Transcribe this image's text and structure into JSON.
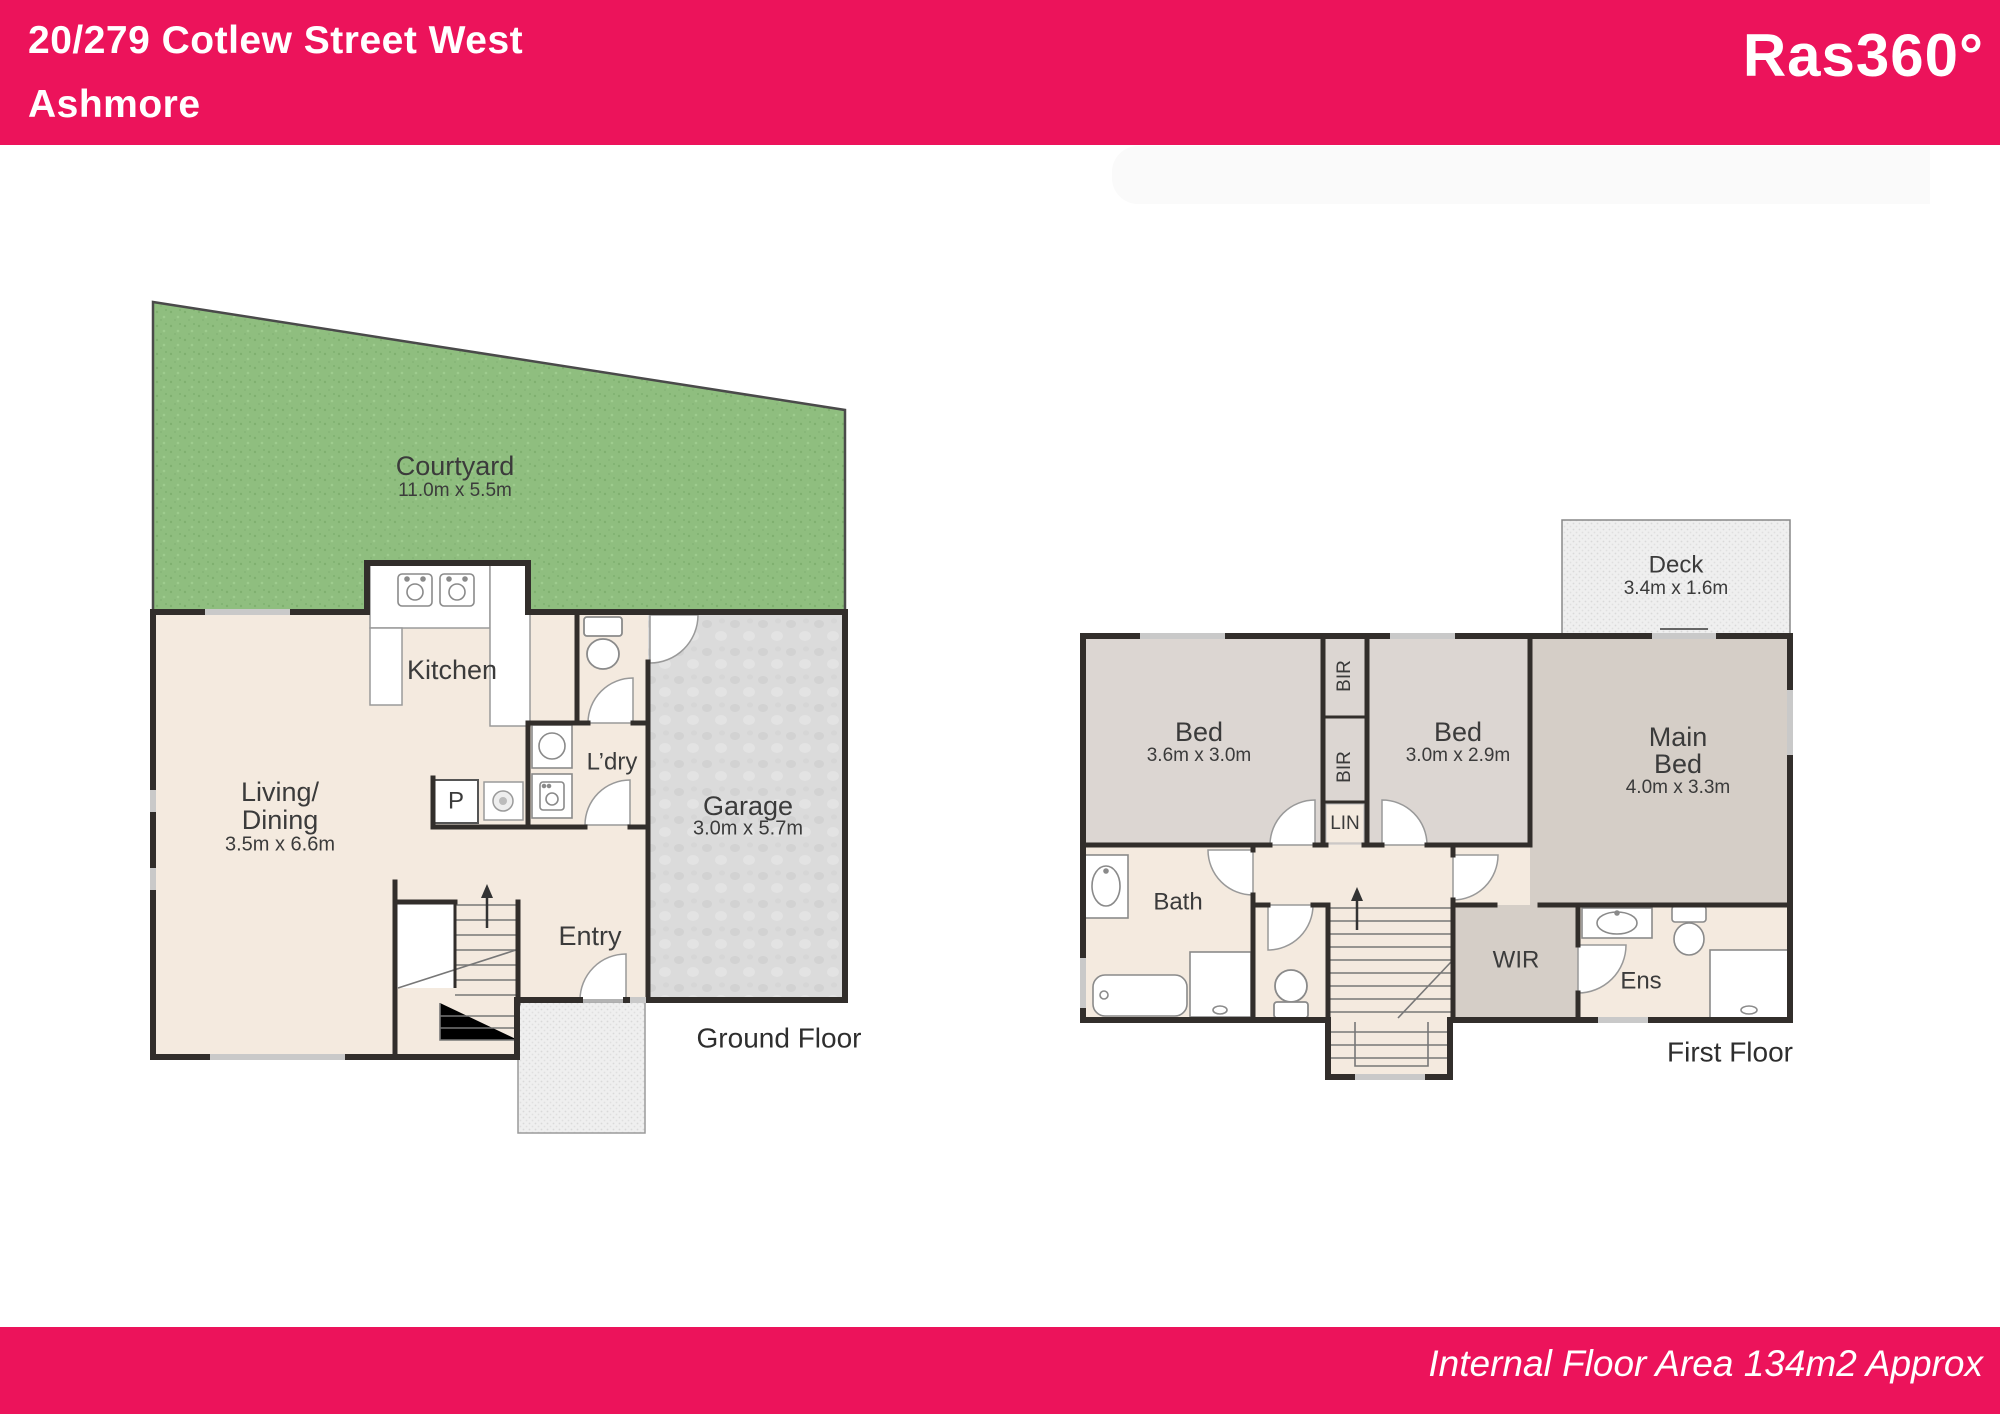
{
  "header": {
    "address_line1": "20/279 Cotlew Street West",
    "address_line2": "Ashmore",
    "brand": "Ras360°"
  },
  "footer": {
    "text": "Internal Floor Area 134m2 Approx"
  },
  "colors": {
    "brand_pink": "#EC135B",
    "courtyard_green": "#8FBE7F",
    "floor_cream": "#F4EADF",
    "room_grey": "#DCD6D2",
    "main_bed_grey": "#D5CEC7",
    "garage_grey": "#DBDBDB",
    "wall_dark": "#322E2B"
  },
  "ground_floor": {
    "label": "Ground Floor",
    "courtyard": {
      "name": "Courtyard",
      "dims": "11.0m x 5.5m"
    },
    "living": {
      "name_line1": "Living/",
      "name_line2": "Dining",
      "dims": "3.5m x 6.6m"
    },
    "kitchen": {
      "name": "Kitchen"
    },
    "laundry": {
      "name": "L’dry"
    },
    "pantry": {
      "name": "P"
    },
    "garage": {
      "name": "Garage",
      "dims": "3.0m x 5.7m"
    },
    "entry": {
      "name": "Entry"
    }
  },
  "first_floor": {
    "label": "First Floor",
    "deck": {
      "name": "Deck",
      "dims": "3.4m x 1.6m"
    },
    "bed1": {
      "name": "Bed",
      "dims": "3.6m x 3.0m"
    },
    "bed2": {
      "name": "Bed",
      "dims": "3.0m x 2.9m"
    },
    "main_bed": {
      "name_line1": "Main",
      "name_line2": "Bed",
      "dims": "4.0m x 3.3m"
    },
    "bir_top": {
      "name": "BIR"
    },
    "bir_bottom": {
      "name": "BIR"
    },
    "linen": {
      "name": "LIN"
    },
    "bath": {
      "name": "Bath"
    },
    "wir": {
      "name": "WIR"
    },
    "ens": {
      "name": "Ens"
    }
  }
}
